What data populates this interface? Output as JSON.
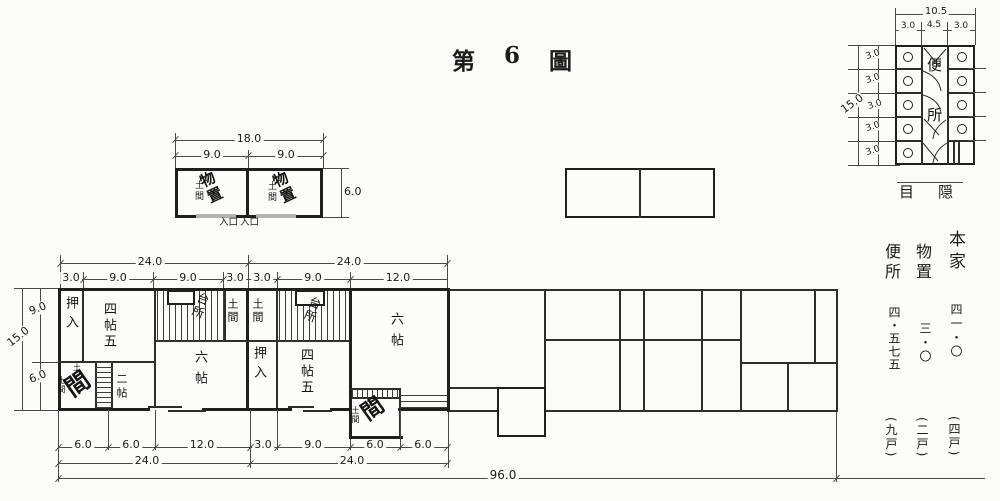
{
  "title": {
    "parts": [
      "第",
      "6",
      "圖"
    ]
  },
  "storage_plan": {
    "dim_total": "18.0",
    "dim_halves": [
      "9.0",
      "9.0"
    ],
    "dim_depth": "6.0",
    "rooms": [
      {
        "name": "物置",
        "sub": "土間"
      },
      {
        "name": "物置",
        "sub": "土間"
      }
    ],
    "entrances": [
      "入口",
      "入口"
    ]
  },
  "toilet_plan": {
    "dim_width_total": "10.5",
    "dims_width": [
      "3.0",
      "4.5",
      "3.0"
    ],
    "dim_height_total": "15.0",
    "dims_height": [
      "3.0",
      "3.0",
      "3.0",
      "3.0",
      "3.0"
    ],
    "name_chars": [
      "便",
      "所"
    ],
    "caption": "目隠"
  },
  "legend": {
    "rows": [
      {
        "name": "本家",
        "area": "四一・〇",
        "units": "(四戸)"
      },
      {
        "name": "物置",
        "area": "三・〇",
        "units": "(二戸)"
      },
      {
        "name": "便所",
        "area": "四・五七五",
        "units": "(九戸)"
      }
    ]
  },
  "main_plan": {
    "dims_top_total": [
      "24.0",
      "24.0"
    ],
    "dims_top_unit1": [
      "3.0",
      "9.0",
      "9.0",
      "3.0"
    ],
    "dims_top_unit2": [
      "3.0",
      "9.0",
      "12.0"
    ],
    "dims_left": {
      "total": "15.0",
      "upper": "9.0",
      "lower": "6.0"
    },
    "dims_bottom": [
      "6.0",
      "6.0",
      "12.0",
      "3.0",
      "9.0",
      "6.0",
      "6.0"
    ],
    "dims_bottom_totals": [
      "24.0",
      "24.0"
    ],
    "dim_overall": "96.0",
    "rooms": {
      "u1_oshiire": "押入",
      "u1_yojohan": "四帖五",
      "u1_daidokoro": "台所",
      "u1_doma": "土間",
      "u1_genkan_tiny": "土",
      "u1_genkan_sub": "土間",
      "u1_genkan_big": "間",
      "u1_nijo": "二帖",
      "u1_rokujo": "六帖",
      "u2_doma": "土間",
      "u2_daidokoro": "台所",
      "u2_rokujo": "六帖",
      "u2_oshiire": "押入",
      "u2_yojohan": "四帖五",
      "u2_genkan_tiny": "土",
      "u2_genkan_sub": "土間",
      "u2_genkan_big": "間"
    }
  }
}
